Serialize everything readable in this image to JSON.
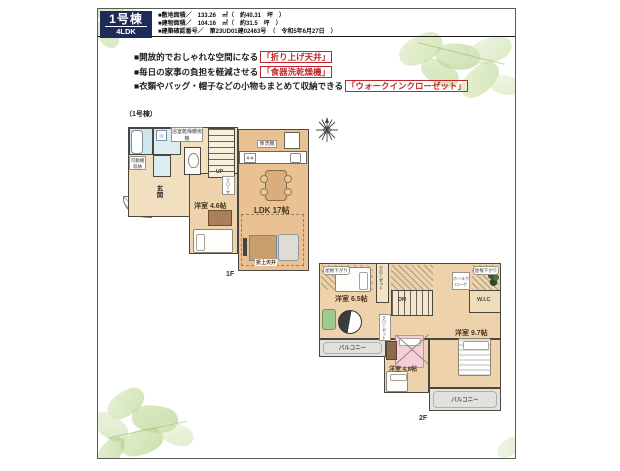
{
  "colors": {
    "navy": "#1e2b58",
    "accent_red": "#c0272d",
    "wall": "#4a4742",
    "floor_main": "#edd2ab",
    "floor_ldk": "#e9c193",
    "floor_hall": "#f2dfbf",
    "wet_area_blue": "#cfe6ec",
    "balcony_gray": "#e2e2dd",
    "leaf_green": "#bcd791"
  },
  "header": {
    "badge_title": "1号棟",
    "badge_subtitle": "4LDK",
    "specs": [
      "■敷地面積／　133.26　㎡（　約40.31　坪　）",
      "■建物面積／　104.16　㎡（　約31.5　坪　）",
      "■建築確認番号／　第23UD01建02463号　（　令和5年6月27日　）"
    ]
  },
  "features": [
    {
      "lead": "■開放的でおしゃれな空間になる",
      "tag": "「折り上げ天井」"
    },
    {
      "lead": "■毎日の家事の負担を軽減させる",
      "tag": "「食器洗乾燥機」"
    },
    {
      "lead": "■衣類やバッグ・帽子などの小物もまとめて収納できる",
      "tag": "「ウォークインクローゼット」"
    }
  ],
  "plan_caption": "（1号棟）",
  "f1": {
    "floor": "1F",
    "ldk": "LDK 17帖",
    "bedroom": "洋室 4.6帖",
    "closet": "クローゼット",
    "bath_dryer": "浴室乾燥暖房機",
    "shelf": "可動棚収納",
    "dishwasher": "食洗機",
    "entrance": "玄関",
    "up": "UP",
    "raised_ceiling": "折上天井"
  },
  "f2": {
    "floor": "2F",
    "bedroom_65": "洋室 6.5帖",
    "bedroom_97": "洋室 9.7帖",
    "bedroom_48": "洋室 4.8帖",
    "closet": "クローゼット",
    "closet_48": "クローゼット",
    "hall_cloak": "ホールクローク",
    "wic": "W.I.C",
    "dn": "DN",
    "roof_left": "屋根下がり",
    "roof_right": "屋根下がり",
    "balcony_left": "バルコニー",
    "balcony_right": "バルコニー"
  }
}
